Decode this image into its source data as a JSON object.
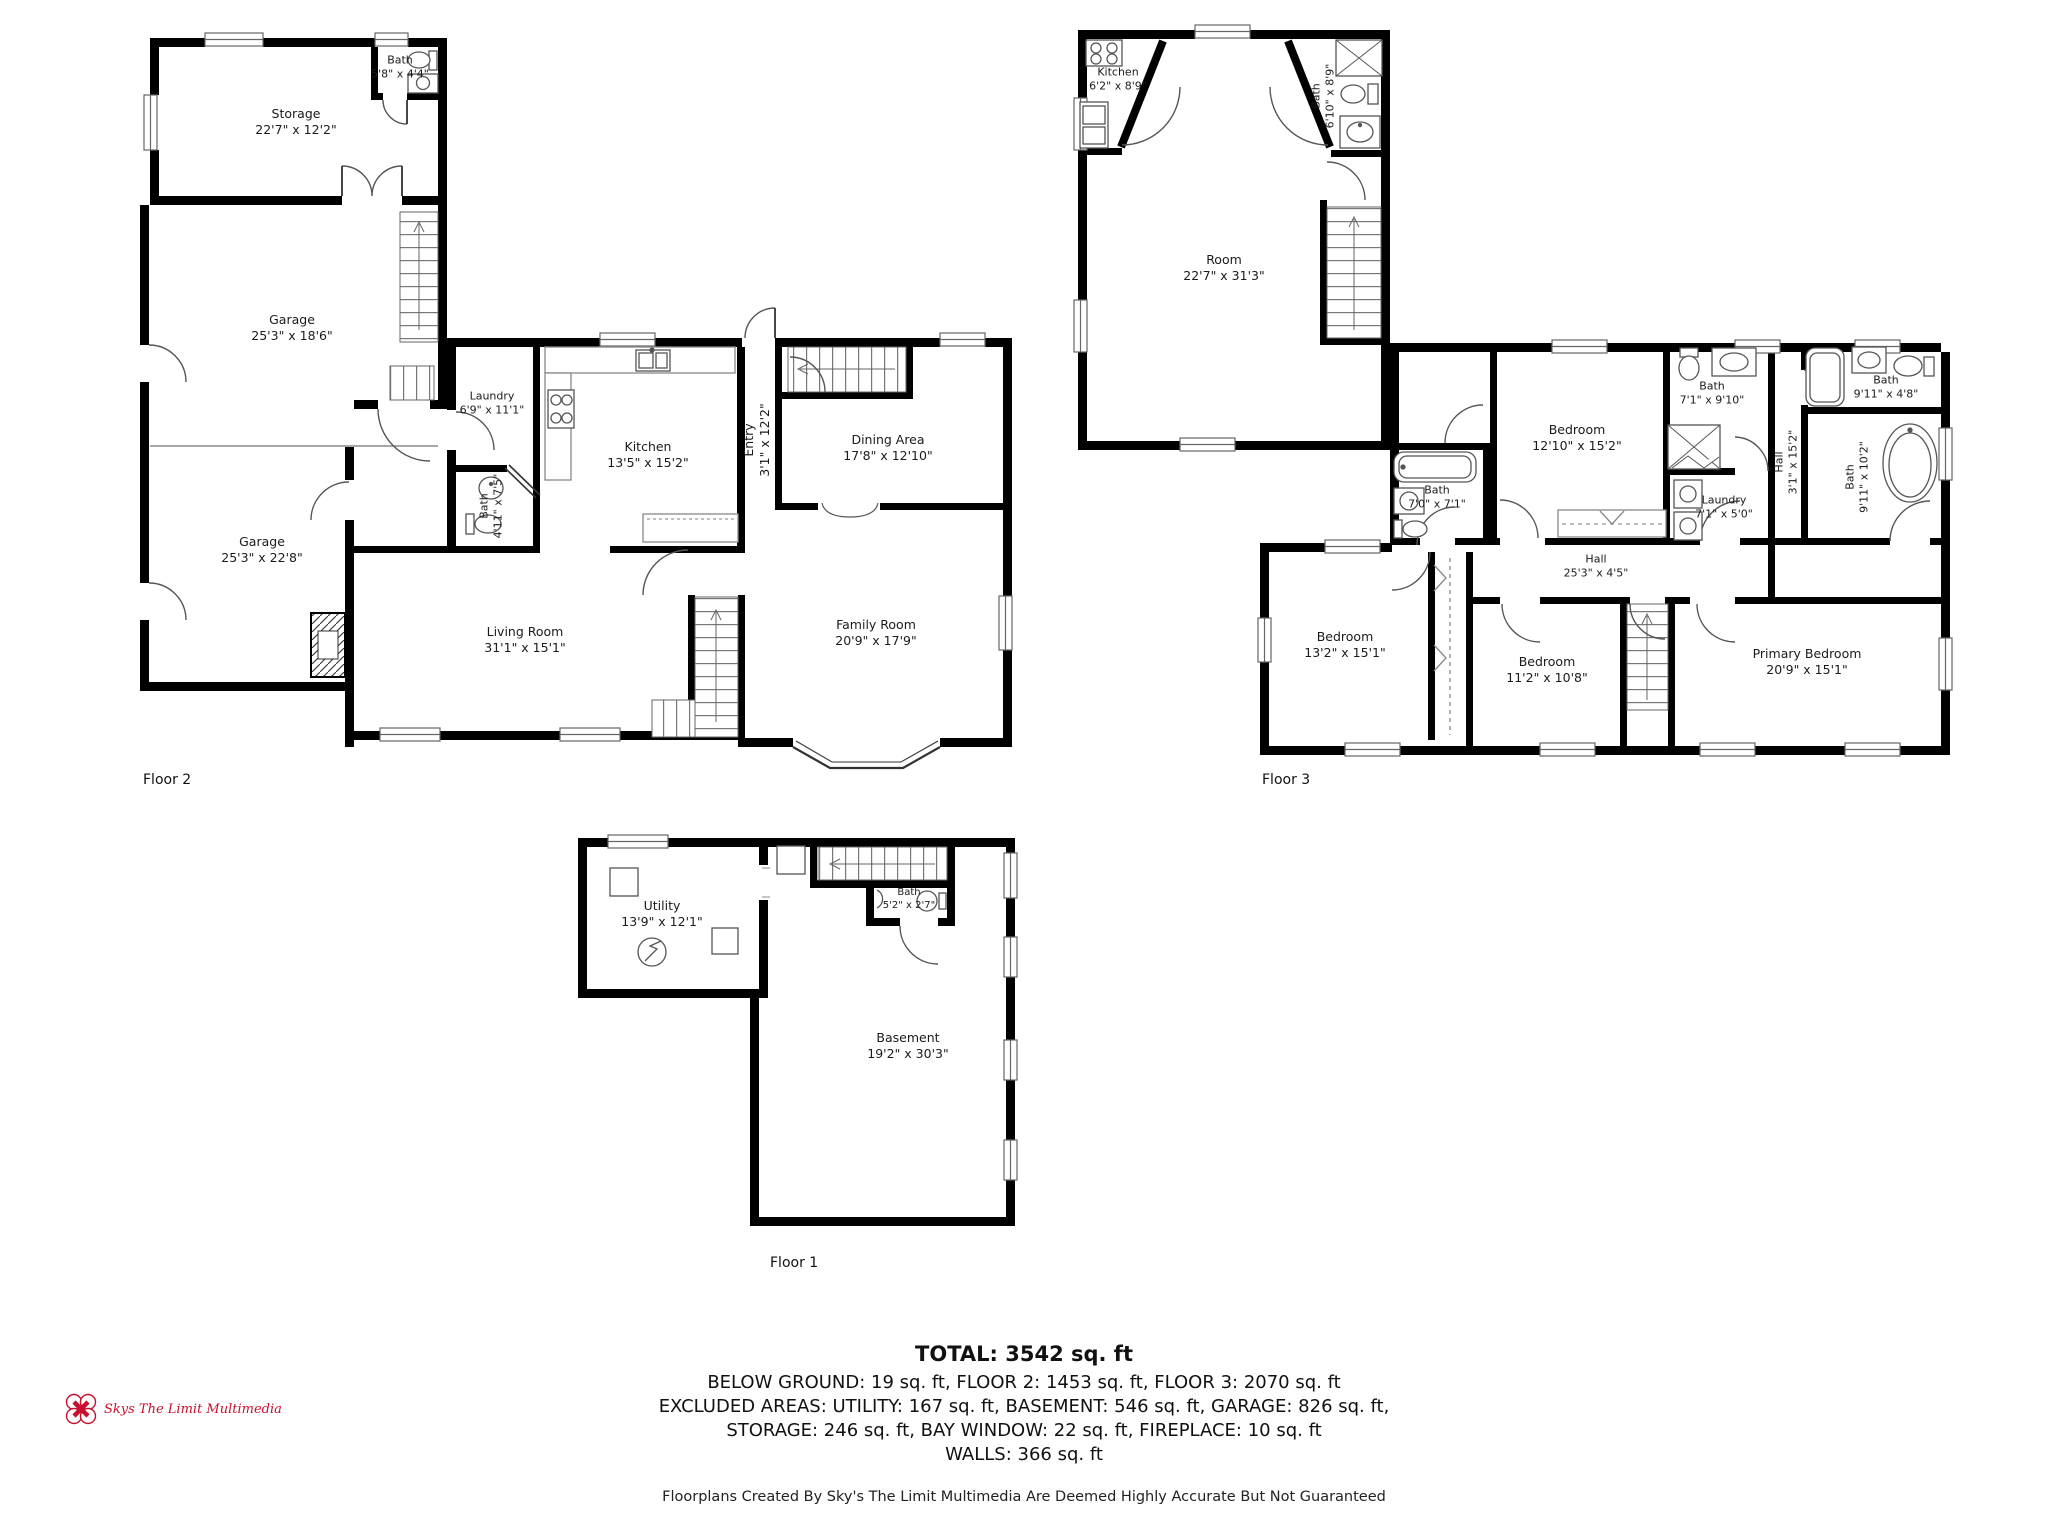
{
  "floors": {
    "floor2": {
      "caption": "Floor 2",
      "rooms": {
        "storage": {
          "name": "Storage",
          "dims": "22'7\" x 12'2\""
        },
        "storage_bath": {
          "name": "Bath",
          "dims": "5'8\" x 4'4\""
        },
        "garage_upper": {
          "name": "Garage",
          "dims": "25'3\" x 18'6\""
        },
        "garage_lower": {
          "name": "Garage",
          "dims": "25'3\" x 22'8\""
        },
        "laundry": {
          "name": "Laundry",
          "dims": "6'9\" x 11'1\""
        },
        "bath": {
          "name": "Bath",
          "dims": "4'11\" x 7'5\""
        },
        "kitchen": {
          "name": "Kitchen",
          "dims": "13'5\" x 15'2\""
        },
        "entry": {
          "name": "Entry",
          "dims": "3'1\" x 12'2\""
        },
        "dining": {
          "name": "Dining Area",
          "dims": "17'8\" x 12'10\""
        },
        "living": {
          "name": "Living Room",
          "dims": "31'1\" x 15'1\""
        },
        "family": {
          "name": "Family Room",
          "dims": "20'9\" x 17'9\""
        }
      }
    },
    "floor3": {
      "caption": "Floor 3",
      "rooms": {
        "kitchen": {
          "name": "Kitchen",
          "dims": "6'2\" x 8'9\""
        },
        "bath_top": {
          "name": "Bath",
          "dims": "6'10\" x 8'9\""
        },
        "room": {
          "name": "Room",
          "dims": "22'7\" x 31'3\""
        },
        "bath_left": {
          "name": "Bath",
          "dims": "7'0\" x 7'1\""
        },
        "bedroom_mid": {
          "name": "Bedroom",
          "dims": "12'10\" x 15'2\""
        },
        "bath_ensuite": {
          "name": "Bath",
          "dims": "7'1\" x 9'10\""
        },
        "bath_corner": {
          "name": "Bath",
          "dims": "9'11\" x 4'8\""
        },
        "hall_v": {
          "name": "Hall",
          "dims": "3'1\" x 15'2\""
        },
        "bath_tub": {
          "name": "Bath",
          "dims": "9'11\" x 10'2\""
        },
        "laundry": {
          "name": "Laundry",
          "dims": "7'1\" x 5'0\""
        },
        "hall_h": {
          "name": "Hall",
          "dims": "25'3\" x 4'5\""
        },
        "bedroom_left": {
          "name": "Bedroom",
          "dims": "13'2\" x 15'1\""
        },
        "bedroom_small": {
          "name": "Bedroom",
          "dims": "11'2\" x 10'8\""
        },
        "primary": {
          "name": "Primary Bedroom",
          "dims": "20'9\" x 15'1\""
        }
      }
    },
    "floor1": {
      "caption": "Floor 1",
      "rooms": {
        "utility": {
          "name": "Utility",
          "dims": "13'9\" x 12'1\""
        },
        "bath": {
          "name": "Bath",
          "dims": "5'2\" x 2'7\""
        },
        "basement": {
          "name": "Basement",
          "dims": "19'2\" x 30'3\""
        }
      }
    }
  },
  "summary": {
    "total": "TOTAL: 3542 sq. ft",
    "line1": "BELOW GROUND: 19 sq. ft, FLOOR 2: 1453 sq. ft, FLOOR 3: 2070 sq. ft",
    "line2": "EXCLUDED AREAS: UTILITY: 167 sq. ft, BASEMENT: 546 sq. ft, GARAGE: 826 sq. ft,",
    "line3": "STORAGE: 246 sq. ft, BAY WINDOW: 22 sq. ft, FIREPLACE: 10 sq. ft",
    "line4": "WALLS: 366 sq. ft",
    "disclaimer": "Floorplans Created By Sky's The Limit Multimedia Are Deemed Highly Accurate But Not Guaranteed"
  },
  "logo": {
    "text": "Skys The Limit Multimedia"
  },
  "colors": {
    "wall": "#000000",
    "fixture": "#555555",
    "brand_red": "#c8102e"
  }
}
